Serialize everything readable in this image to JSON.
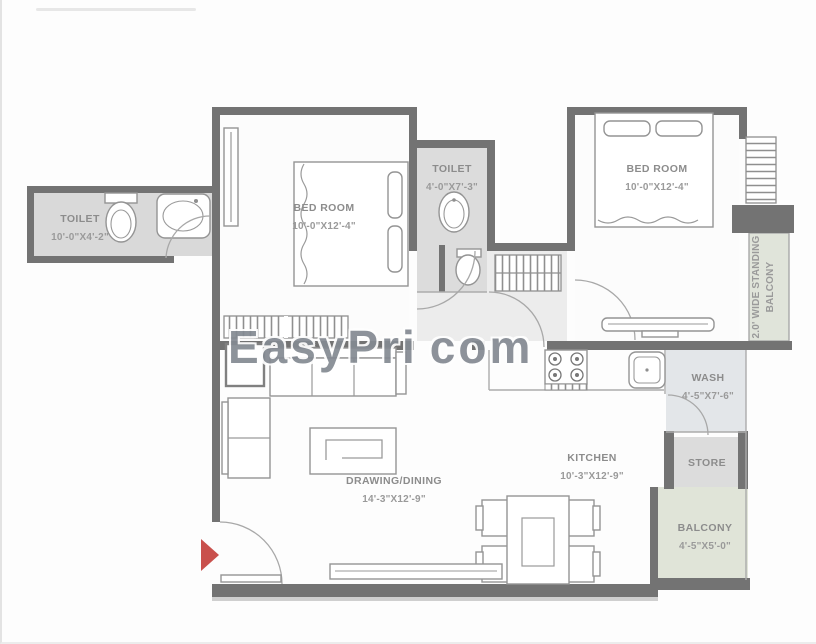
{
  "watermark": {
    "left": "EasyPri",
    "right": "com"
  },
  "colors": {
    "wall": "#737373",
    "room_fill_gray": "#d9d9d9",
    "wash_fill": "#e3e6e9",
    "balcony_fill": "#e0e4d8",
    "label_text": "#8c8c8c",
    "entrance_arrow": "#c9504c"
  },
  "rooms": {
    "toilet1": {
      "name": "TOILET",
      "dims": "10'-0\"X4'-2\""
    },
    "bedroom1": {
      "name": "BED ROOM",
      "dims": "10'-0\"X12'-4\""
    },
    "toilet2": {
      "name": "TOILET",
      "dims": "4'-0\"X7'-3\""
    },
    "bedroom2": {
      "name": "BED ROOM",
      "dims": "10'-0\"X12'-4\""
    },
    "standing_balcony": {
      "line1": "2.0' WIDE STANDING",
      "line2": "BALCONY"
    },
    "drawing_dining": {
      "name": "DRAWING/DINING",
      "dims": "14'-3\"X12'-9\""
    },
    "kitchen": {
      "name": "KITCHEN",
      "dims": "10'-3\"X12'-9\""
    },
    "wash": {
      "name": "WASH",
      "dims": "4'-5\"X7'-6\""
    },
    "store": {
      "name": "STORE"
    },
    "balcony": {
      "name": "BALCONY",
      "dims": "4'-5\"X5'-0\""
    }
  }
}
